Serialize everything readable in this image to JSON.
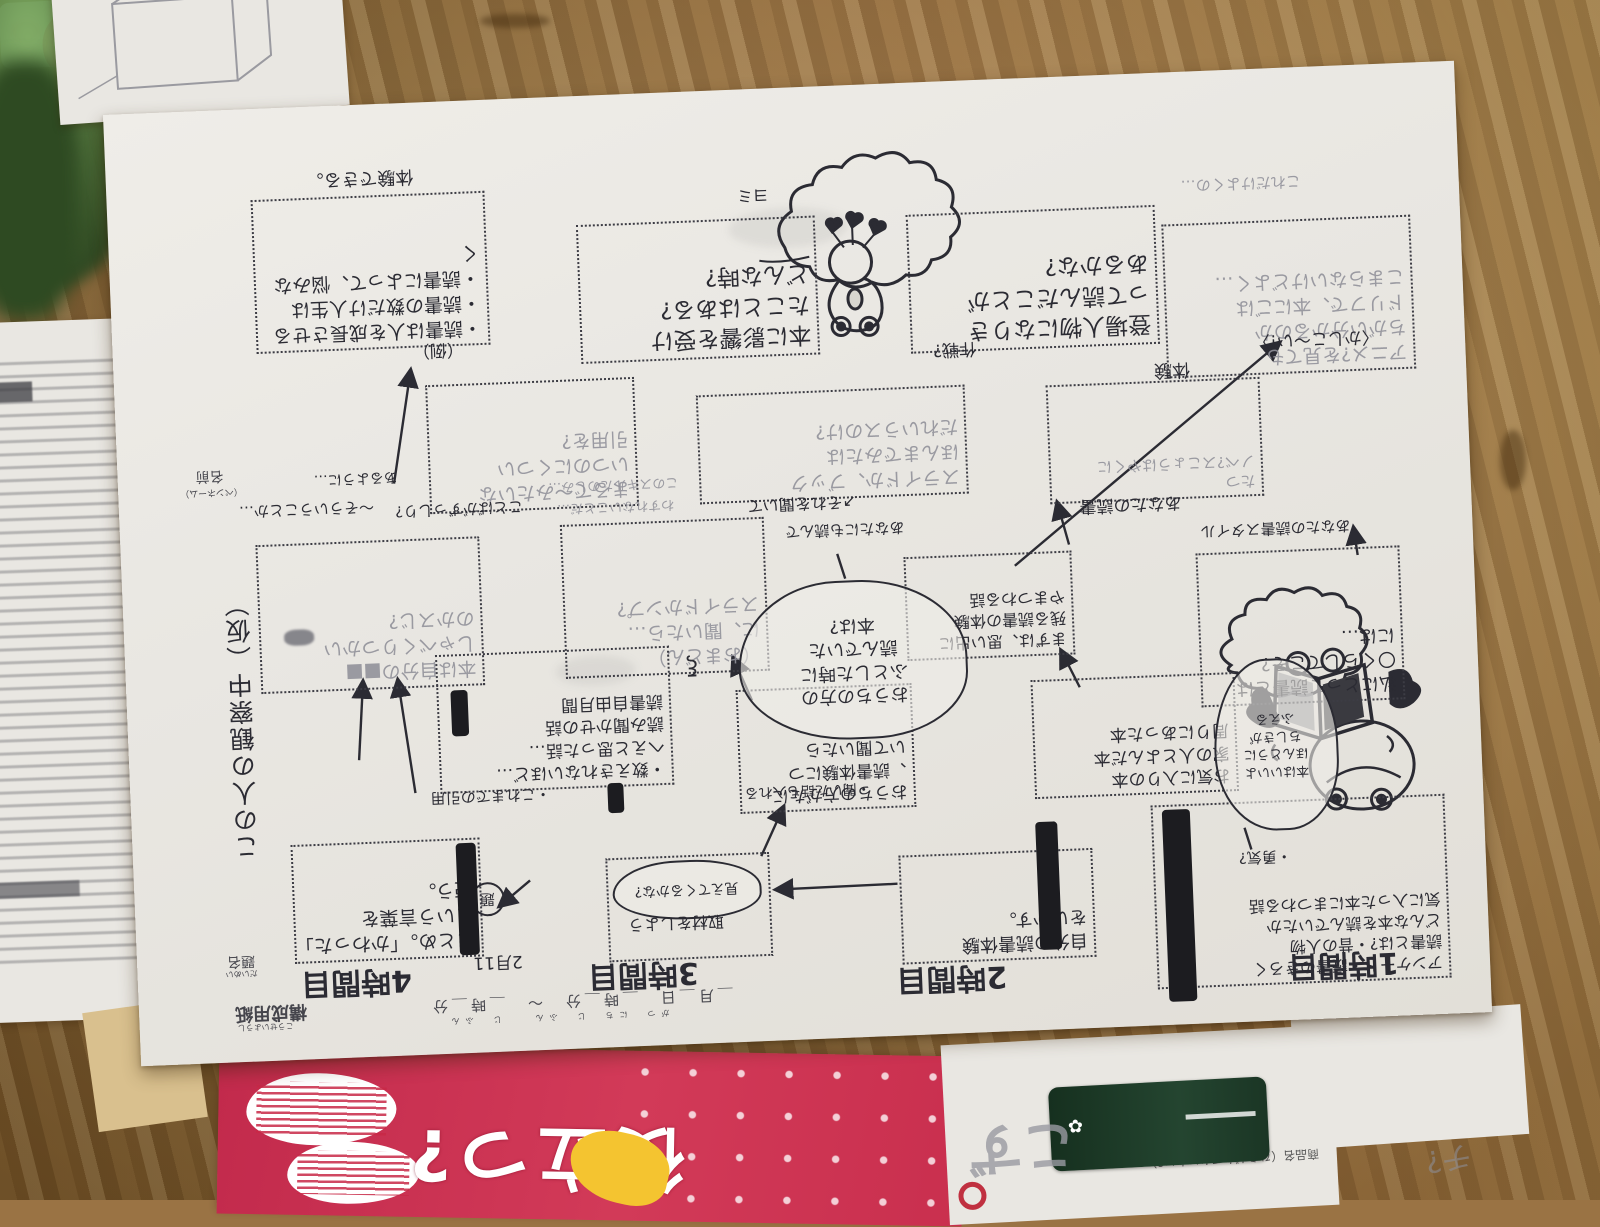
{
  "scene": {
    "desk_colors": {
      "base": "#9a7344",
      "light": "#c5a065",
      "dark": "#6f5228"
    },
    "objects": [
      "wooden-desk",
      "green-plant-blur",
      "papers",
      "red-booklet",
      "pink-ring-sticker"
    ]
  },
  "main_sheet": {
    "orientation": "upside-down handwritten worksheet",
    "printed": {
      "name_label": "名前",
      "name_sub": "（ペンネーム）",
      "title_label": "題名",
      "title_kana": "だいめい",
      "sheet_label": "構成用紙",
      "sheet_kana": "こうせいようし",
      "datetime_line": "＿月＿日　＿時＿分　〜　＿時＿分",
      "datetime_kana": "がつ　にち　じ　ふん　　じ　ふん"
    },
    "title_vertical": "この人の観察中（仮）",
    "date_note": "2月11",
    "period_labels": [
      {
        "text": "4時間目",
        "x": 163,
        "y": 858
      },
      {
        "text": "3時間目",
        "x": 450,
        "y": 862
      },
      {
        "text": "2時間目",
        "x": 758,
        "y": 878
      },
      {
        "text": "1時間目",
        "x": 1150,
        "y": 880
      }
    ],
    "boxes": [
      {
        "id": "box-example",
        "x": 144,
        "y": 91,
        "w": 230,
        "h": 150,
        "ink": "pen",
        "fs": 19,
        "lines": [
          "・読書は人を成長させる",
          "・読書の数だけ人生は",
          "・読書によって、悩みなく"
        ]
      },
      {
        "id": "box-influence",
        "x": 468,
        "y": 129,
        "w": 235,
        "h": 135,
        "ink": "pen",
        "fs": 23,
        "lines": [
          "本に影響を受け",
          "たことはある?",
          "どんな時?"
        ]
      },
      {
        "id": "box-character",
        "x": 798,
        "y": 132,
        "w": 245,
        "h": 135,
        "ink": "pen",
        "fs": 23,
        "lines": [
          "登場人物になりき",
          "って読んだことが",
          "あるかな?"
        ]
      },
      {
        "id": "box-anime",
        "x": 1053,
        "y": 152,
        "w": 245,
        "h": 150,
        "ink": "pencil",
        "fs": 19,
        "lines": [
          "アニメ?を見ても",
          "ちがい分かるのか",
          "ドリフで、本にごは",
          "こまらないけどよく…"
        ]
      },
      {
        "id": "box-simile",
        "x": 311,
        "y": 283,
        "w": 205,
        "h": 125,
        "ink": "pencil",
        "fs": 19,
        "lines": [
          "まるで〜みたいな",
          "いつのにくつい",
          "引用を?"
        ]
      },
      {
        "id": "box-slide",
        "x": 581,
        "y": 304,
        "w": 265,
        "h": 105,
        "ink": "pencil",
        "fs": 19,
        "lines": [
          "スライドか、ブック",
          "ほんまでみたは",
          "だれいうスのけ?"
        ]
      },
      {
        "id": "box-your-reading",
        "x": 931,
        "y": 308,
        "w": 210,
        "h": 115,
        "ink": "pencil",
        "fs": 15,
        "lines": [
          "たつ",
          "ノベ?スこょうはやくに"
        ]
      },
      {
        "id": "box-mirror",
        "x": 135,
        "y": 436,
        "w": 220,
        "h": 145,
        "ink": "pencil",
        "fs": 19,
        "lines": [
          "本は自分の■■",
          "しゃべくりつかい",
          "のかスじ?"
        ]
      },
      {
        "id": "box-omadon",
        "x": 440,
        "y": 428,
        "w": 200,
        "h": 150,
        "ink": "pencil",
        "fs": 19,
        "lines": [
          "（おまどん）",
          "に、聞いたら…",
          "スライドかンプ?"
        ]
      },
      {
        "id": "box-memories",
        "x": 782,
        "y": 474,
        "w": 164,
        "h": 100,
        "ink": "pen",
        "fs": 16,
        "lines": [
          "まずは、思い出に",
          "残る読書の体験",
          "やまつわる話"
        ]
      },
      {
        "id": "box-mystyle",
        "x": 1074,
        "y": 482,
        "w": 200,
        "h": 150,
        "ink": "pen",
        "fs": 18,
        "lines": [
          "私にとって読書とは",
          "〇くらしてこそ?",
          "には…"
        ]
      },
      {
        "id": "box-quotes",
        "x": 310,
        "y": 553,
        "w": 230,
        "h": 135,
        "ink": "pen",
        "fs": 17,
        "lines": [
          "・数えきれないほど…",
          "へえと思った話…",
          "読み聞かせの話",
          "読書自由月間"
        ]
      },
      {
        "id": "box-ask-family",
        "x": 609,
        "y": 600,
        "w": 172,
        "h": 120,
        "ink": "pen",
        "fs": 17,
        "lines": [
          "おうちの方がたに",
          "、読書体験につ",
          "いて聞いたら"
        ]
      },
      {
        "id": "box-books-around",
        "x": 904,
        "y": 602,
        "w": 200,
        "h": 115,
        "ink": "pen",
        "fs": 17,
        "lines": [
          "お気に入りの本",
          "家の人とよんだ本",
          "周りにあった本"
        ]
      },
      {
        "id": "box-matome",
        "x": 158,
        "y": 737,
        "w": 185,
        "h": 115,
        "ink": "pen",
        "fs": 19,
        "lines": [
          "まとめ。「かわった」",
          "という言葉を",
          "使う。"
        ]
      },
      {
        "id": "box-shuzai",
        "x": 472,
        "y": 763,
        "w": 160,
        "h": 100,
        "ink": "pen",
        "fs": 15,
        "lines": []
      },
      {
        "id": "box-use-experience",
        "x": 765,
        "y": 772,
        "w": 190,
        "h": 105,
        "ink": "pen",
        "fs": 18,
        "lines": [
          "自分の読書体験",
          "をいかす。"
        ]
      },
      {
        "id": "box-survey",
        "x": 1019,
        "y": 732,
        "w": 290,
        "h": 180,
        "ink": "pen",
        "fs": 16,
        "lines": [
          "アンケート・読書のきろく",
          "読書とは?・昔の人物",
          "どんな本を読んでいたか",
          "気に入った本にまつわる話"
        ]
      }
    ],
    "clouds": [
      {
        "id": "cloud-family-books",
        "x": 613,
        "y": 495,
        "w": 225,
        "h": 155,
        "fs": 18,
        "ink": "pen",
        "lines": [
          "おうちの方の",
          "ふとした時に",
          "読んでいた",
          "本は?"
        ]
      },
      {
        "id": "cloud-mieru",
        "x": 478,
        "y": 768,
        "w": 145,
        "h": 55,
        "fs": 14,
        "ink": "pen",
        "lines": [
          "見えてくるかな?"
        ]
      }
    ],
    "notes": [
      {
        "id": "note-example",
        "text": "（例）",
        "x": 300,
        "y": 238,
        "fs": 17,
        "ink": "pen"
      },
      {
        "id": "note-taiken-dekiru",
        "text": "体験できる。",
        "x": 200,
        "y": 62,
        "fs": 18,
        "ink": "pen"
      },
      {
        "id": "note-yomi",
        "text": "ヨミ",
        "x": 630,
        "y": 96,
        "fs": 16,
        "ink": "pen"
      },
      {
        "id": "note-sakusen",
        "text": "作戦?",
        "x": 820,
        "y": 258,
        "fs": 17,
        "ink": "pen"
      },
      {
        "id": "note-koredake",
        "text": "これだけよくの…",
        "x": 1074,
        "y": 104,
        "fs": 15,
        "ink": "pencil"
      },
      {
        "id": "note-kashikoi",
        "text": "〈かしこ〜い!〉",
        "x": 1140,
        "y": 262,
        "fs": 17,
        "ink": "pen"
      },
      {
        "id": "note-taiken",
        "text": "体験",
        "x": 1040,
        "y": 286,
        "fs": 18,
        "ink": "pen"
      },
      {
        "id": "note-anata-dokusho",
        "text": "あなたの読書",
        "x": 960,
        "y": 420,
        "fs": 17,
        "ink": "pen"
      },
      {
        "id": "note-style",
        "text": "あなたの読書スタイル",
        "x": 1080,
        "y": 450,
        "fs": 15,
        "ink": "pen"
      },
      {
        "id": "note-sorekiite",
        "text": "↗それを聞いて",
        "x": 628,
        "y": 406,
        "fs": 16,
        "ink": "pen"
      },
      {
        "id": "note-anatanimo",
        "text": "あなたにも読んで",
        "x": 665,
        "y": 434,
        "fs": 15,
        "ink": "pen"
      },
      {
        "id": "note-kotoba",
        "text": "ことばがずっしり?",
        "x": 276,
        "y": 398,
        "fs": 15,
        "ink": "pen"
      },
      {
        "id": "note-souiukoto",
        "text": "〜そういうことか…",
        "x": 120,
        "y": 392,
        "fs": 15,
        "ink": "pen"
      },
      {
        "id": "note-aruyouni",
        "text": "あるように…",
        "x": 196,
        "y": 364,
        "fs": 14,
        "ink": "pen"
      },
      {
        "id": "note-skill1",
        "text": "このスキルたのしみ…",
        "x": 430,
        "y": 382,
        "fs": 13,
        "ink": "pencil"
      },
      {
        "id": "note-skill2",
        "text": "わすれないことだ…",
        "x": 438,
        "y": 404,
        "fs": 13,
        "ink": "pencil"
      },
      {
        "id": "note-inyou",
        "text": "・これまでの引用",
        "x": 300,
        "y": 686,
        "fs": 15,
        "ink": "pen"
      },
      {
        "id": "note-kiitahanashi",
        "text": "・聞いた話も入れる",
        "x": 614,
        "y": 694,
        "fs": 14,
        "ink": "pen"
      },
      {
        "id": "note-yuki",
        "text": "・勇気?",
        "x": 1105,
        "y": 778,
        "fs": 15,
        "ink": "pen"
      },
      {
        "id": "note-squiggle",
        "text": "ξ",
        "x": 560,
        "y": 562,
        "fs": 22,
        "ink": "pen"
      },
      {
        "id": "note-shuzai",
        "text": "取材をしよう",
        "x": 492,
        "y": 820,
        "fs": 16,
        "ink": "pen"
      },
      {
        "id": "note-date",
        "text": "2月11",
        "x": 336,
        "y": 852,
        "fs": 17,
        "ink": "pen"
      }
    ],
    "frog_bubble_lines": [
      "本はいいよ",
      "ほんとうに",
      "ちしきが",
      "ふえる"
    ],
    "circled_glyph": "題",
    "black_bars": [
      {
        "x": 323,
        "y": 742,
        "w": 20,
        "h": 112
      },
      {
        "x": 903,
        "y": 744,
        "w": 22,
        "h": 128
      },
      {
        "x": 1030,
        "y": 737,
        "w": 28,
        "h": 192
      },
      {
        "x": 477,
        "y": 688,
        "w": 16,
        "h": 30
      },
      {
        "x": 324,
        "y": 589,
        "w": 17,
        "h": 46
      }
    ],
    "arrows": [
      {
        "x1": 276,
        "y1": 380,
        "x2": 297,
        "y2": 268
      },
      {
        "x1": 628,
        "y1": 767,
        "x2": 652,
        "y2": 719
      },
      {
        "x1": 763,
        "y1": 800,
        "x2": 642,
        "y2": 801
      },
      {
        "x1": 230,
        "y1": 655,
        "x2": 237,
        "y2": 577
      },
      {
        "x1": 285,
        "y1": 690,
        "x2": 272,
        "y2": 577
      },
      {
        "x1": 625,
        "y1": 611,
        "x2": 608,
        "y2": 568
      },
      {
        "x1": 953,
        "y1": 611,
        "x2": 936,
        "y2": 574
      },
      {
        "x1": 948,
        "y1": 468,
        "x2": 938,
        "y2": 426
      },
      {
        "x1": 893,
        "y1": 487,
        "x2": 1166,
        "y2": 275
      },
      {
        "x1": 396,
        "y1": 782,
        "x2": 365,
        "y2": 806
      },
      {
        "x1": 1236,
        "y1": 490,
        "x2": 1233,
        "y2": 463
      }
    ],
    "plain_lines": [
      {
        "x1": 723,
        "y1": 493,
        "x2": 716,
        "y2": 468
      },
      {
        "x1": 1112,
        "y1": 758,
        "x2": 1118,
        "y2": 780
      }
    ]
  },
  "left_paper": {
    "description": "printed worksheet, blurred",
    "header_fragment": "週"
  },
  "top_left_paper": {
    "sketch": "pencil-box-diagram"
  },
  "sticker": {
    "ring_color": "#d6336c"
  },
  "booklet": {
    "bg_color": "#c9304f",
    "cover_text": "役立つ?",
    "bubble_note": "学校では教えてくれない大切なこと?"
  },
  "bottom_right_paper": {
    "header": "商品名（ひらがなでかいたい?）",
    "pencil_note": "こず",
    "item_color": "#22392c",
    "logo_color": "#c03040"
  },
  "far_right_scribble": "チ?"
}
